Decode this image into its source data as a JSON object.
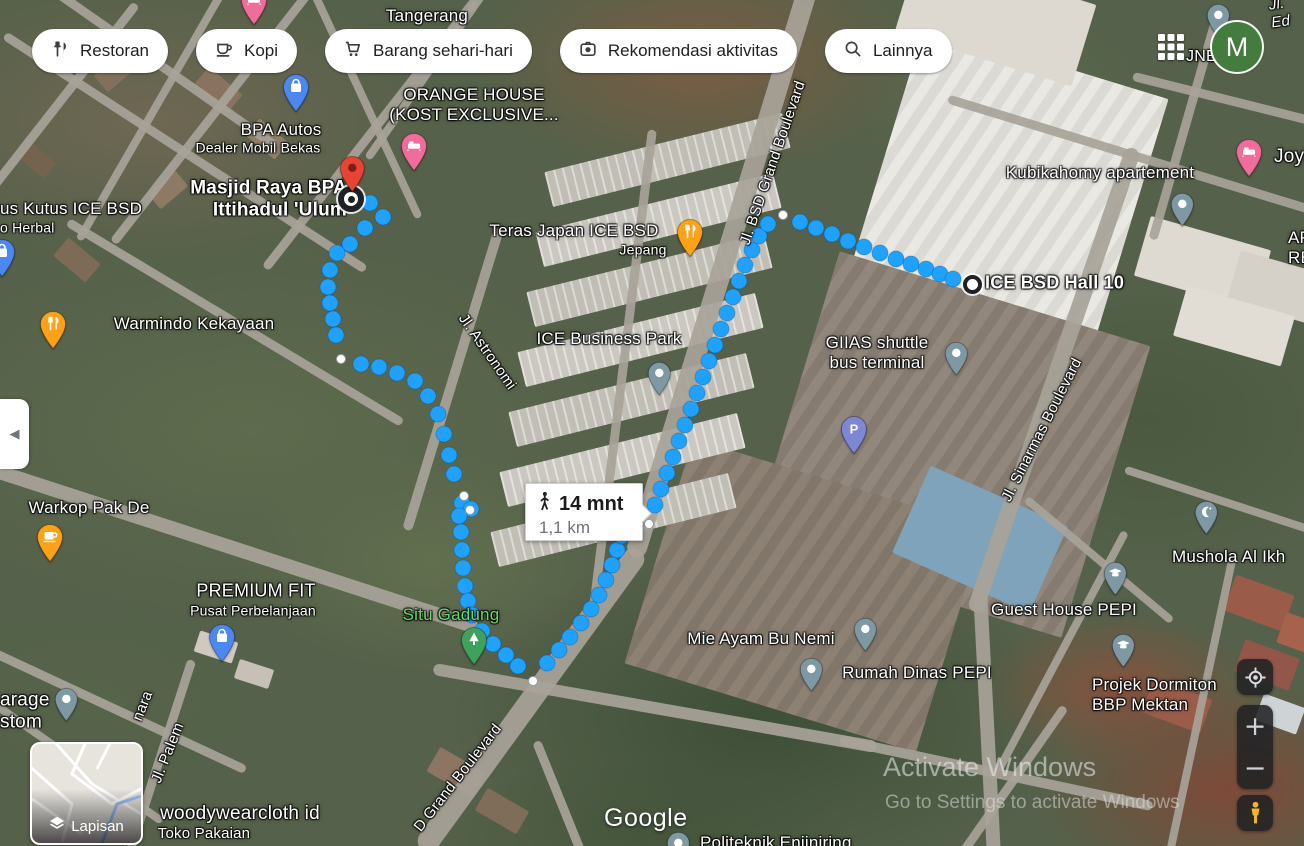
{
  "chips": [
    {
      "label": "Restoran",
      "icon": "restaurant-icon"
    },
    {
      "label": "Kopi",
      "icon": "coffee-icon"
    },
    {
      "label": "Barang sehari-hari",
      "icon": "cart-icon"
    },
    {
      "label": "Rekomendasi aktivitas",
      "icon": "camera-icon"
    },
    {
      "label": "Lainnya",
      "icon": "search-icon"
    }
  ],
  "topbar": {
    "jne_label": "JNE",
    "avatar_initial": "M"
  },
  "controls": {
    "layers_label": "Lapisan",
    "zoom_in": "+",
    "zoom_out": "−"
  },
  "watermarks": {
    "google": "Google",
    "activate_line1": "Activate Windows",
    "activate_line2": "Go to Settings to activate Windows"
  },
  "route": {
    "mode": "walking",
    "duration": "14 mnt",
    "distance": "1,1 km",
    "dot_color": "#1FA1FF",
    "start": [
      351,
      199
    ],
    "end": [
      972,
      284
    ],
    "dots": [
      [
        370,
        203
      ],
      [
        383,
        217
      ],
      [
        365,
        228
      ],
      [
        350,
        244
      ],
      [
        337,
        253
      ],
      [
        330,
        270
      ],
      [
        328,
        287
      ],
      [
        330,
        303
      ],
      [
        333,
        319
      ],
      [
        336,
        335
      ],
      [
        361,
        364
      ],
      [
        379,
        367
      ],
      [
        397,
        373
      ],
      [
        415,
        381
      ],
      [
        428,
        396
      ],
      [
        438,
        414
      ],
      [
        444,
        434
      ],
      [
        449,
        455
      ],
      [
        454,
        474
      ],
      [
        462,
        503
      ],
      [
        471,
        509
      ],
      [
        459,
        516
      ],
      [
        461,
        532
      ],
      [
        462,
        550
      ],
      [
        463,
        568
      ],
      [
        465,
        586
      ],
      [
        468,
        601
      ],
      [
        472,
        615
      ],
      [
        482,
        631
      ],
      [
        493,
        644
      ],
      [
        506,
        655
      ],
      [
        518,
        666
      ],
      [
        547,
        663
      ],
      [
        559,
        650
      ],
      [
        570,
        637
      ],
      [
        581,
        623
      ],
      [
        591,
        609
      ],
      [
        599,
        595
      ],
      [
        606,
        580
      ],
      [
        612,
        565
      ],
      [
        617,
        550
      ],
      [
        622,
        536
      ],
      [
        633,
        528
      ],
      [
        655,
        505
      ],
      [
        661,
        489
      ],
      [
        667,
        473
      ],
      [
        673,
        457
      ],
      [
        679,
        441
      ],
      [
        685,
        425
      ],
      [
        691,
        409
      ],
      [
        697,
        393
      ],
      [
        703,
        377
      ],
      [
        709,
        361
      ],
      [
        715,
        345
      ],
      [
        721,
        329
      ],
      [
        727,
        313
      ],
      [
        733,
        297
      ],
      [
        739,
        281
      ],
      [
        745,
        265
      ],
      [
        752,
        250
      ],
      [
        759,
        236
      ],
      [
        768,
        224
      ],
      [
        800,
        222
      ],
      [
        816,
        228
      ],
      [
        832,
        234
      ],
      [
        848,
        241
      ],
      [
        864,
        247
      ],
      [
        880,
        253
      ],
      [
        896,
        259
      ],
      [
        911,
        264
      ],
      [
        926,
        269
      ],
      [
        940,
        274
      ],
      [
        953,
        279
      ]
    ],
    "waypoints": [
      [
        341,
        359
      ],
      [
        464,
        496
      ],
      [
        470,
        510
      ],
      [
        533,
        681
      ],
      [
        649,
        524
      ],
      [
        783,
        215
      ]
    ]
  },
  "markers": [
    {
      "name": "pin-hotel-top",
      "x": 254,
      "y": 26,
      "color": "#F06C9B",
      "icon": "bed"
    },
    {
      "name": "pin-bpa-autos",
      "x": 296,
      "y": 113,
      "color": "#4C88F5",
      "icon": "bag"
    },
    {
      "name": "pin-left-edge-shop",
      "x": 2,
      "y": 278,
      "color": "#4C88F5",
      "icon": "bag"
    },
    {
      "name": "pin-orange-house",
      "x": 414,
      "y": 172,
      "color": "#F06C9B",
      "icon": "bed"
    },
    {
      "name": "pin-joyland",
      "x": 1249,
      "y": 178,
      "color": "#F06C9B",
      "icon": "bed"
    },
    {
      "name": "pin-warmindo-kekayaan",
      "x": 53,
      "y": 350,
      "color": "#FFA114",
      "icon": "restaurant"
    },
    {
      "name": "pin-teras-japan",
      "x": 690,
      "y": 258,
      "color": "#FFA114",
      "icon": "restaurant"
    },
    {
      "name": "pin-warkop-pak-de",
      "x": 50,
      "y": 563,
      "color": "#FFA114",
      "icon": "coffee"
    },
    {
      "name": "pin-premium-fit",
      "x": 222,
      "y": 663,
      "color": "#4C88F5",
      "icon": "bag"
    },
    {
      "name": "pin-ice-business-park",
      "x": 659,
      "y": 396,
      "color": "#7E99A3",
      "icon": "dot"
    },
    {
      "name": "pin-giias-shuttle",
      "x": 956,
      "y": 376,
      "color": "#7E99A3",
      "icon": "dot"
    },
    {
      "name": "pin-kubikahomy",
      "x": 1182,
      "y": 227,
      "color": "#7E99A3",
      "icon": "dot"
    },
    {
      "name": "pin-mie-ayam",
      "x": 865,
      "y": 652,
      "color": "#7E99A3",
      "icon": "dot"
    },
    {
      "name": "pin-rumah-dinas",
      "x": 811,
      "y": 692,
      "color": "#7E99A3",
      "icon": "dot"
    },
    {
      "name": "pin-top-right",
      "x": 1218,
      "y": 38,
      "color": "#7E99A3",
      "icon": "dot"
    },
    {
      "name": "pin-mushola",
      "x": 1206,
      "y": 535,
      "color": "#7E99A3",
      "icon": "crescent"
    },
    {
      "name": "pin-guest-house-pepi",
      "x": 1115,
      "y": 596,
      "color": "#7E99A3",
      "icon": "grad"
    },
    {
      "name": "pin-projek-dormiton",
      "x": 1123,
      "y": 668,
      "color": "#7E99A3",
      "icon": "grad"
    },
    {
      "name": "pin-parking",
      "x": 854,
      "y": 455,
      "color": "#7E86D6",
      "icon": "parking"
    },
    {
      "name": "pin-situ-gadung",
      "x": 474,
      "y": 666,
      "color": "#3FA25C",
      "icon": "tree"
    },
    {
      "name": "pin-bottom-left",
      "x": 66,
      "y": 722,
      "color": "#7E99A3",
      "icon": "dot"
    },
    {
      "name": "pin-politeknik",
      "x": 678,
      "y": 866,
      "color": "#7E99A3",
      "icon": "dot"
    },
    {
      "name": "pin-destination-red",
      "x": 352,
      "y": 193,
      "color": "#E94335",
      "icon": "red-pin"
    }
  ],
  "labels": [
    {
      "name": "label-tangerang",
      "text": "Tangerang",
      "x": 427,
      "y": 16,
      "size": 17
    },
    {
      "name": "label-orange-house",
      "text": "ORANGE HOUSE\n(KOST EXCLUSIVE...",
      "x": 474,
      "y": 105,
      "size": 17
    },
    {
      "name": "label-bpa-autos",
      "text": "BPA Autos",
      "x": 281,
      "y": 130,
      "size": 17
    },
    {
      "name": "label-bpa-autos-sub",
      "text": "Dealer Mobil Bekas",
      "x": 258,
      "y": 148,
      "size": 14,
      "weight": 400
    },
    {
      "name": "label-masjid-raya",
      "text": "Masjid Raya BPA\nIttihadul 'Ulum",
      "x": 347,
      "y": 200,
      "size": 19,
      "weight": 700,
      "align": "right"
    },
    {
      "name": "label-teras-japan",
      "text": "Teras Japan ICE BSD",
      "x": 574,
      "y": 231,
      "size": 17
    },
    {
      "name": "label-teras-japan-sub",
      "text": "Jepang",
      "x": 643,
      "y": 250,
      "size": 14,
      "weight": 400
    },
    {
      "name": "label-ice-business-park",
      "text": "ICE Business Park",
      "x": 609,
      "y": 339,
      "size": 17
    },
    {
      "name": "label-kubikahomy",
      "text": "Kubikahomy apartement",
      "x": 1100,
      "y": 173,
      "size": 17
    },
    {
      "name": "label-ice-bsd-hall-10",
      "text": "ICE BSD Hall 10",
      "x": 985,
      "y": 283,
      "size": 18,
      "weight": 700,
      "align": "left"
    },
    {
      "name": "label-giias",
      "text": "GIIAS shuttle\nbus terminal",
      "x": 877,
      "y": 353,
      "size": 17
    },
    {
      "name": "label-warmindo",
      "text": "Warmindo Kekayaan",
      "x": 194,
      "y": 324,
      "size": 17
    },
    {
      "name": "label-warkop",
      "text": "Warkop Pak De",
      "x": 89,
      "y": 508,
      "size": 17
    },
    {
      "name": "label-premium-fit",
      "text": "PREMIUM FIT",
      "x": 256,
      "y": 591,
      "size": 18
    },
    {
      "name": "label-premium-fit-sub",
      "text": "Pusat Perbelanjaan",
      "x": 253,
      "y": 611,
      "size": 14,
      "weight": 400
    },
    {
      "name": "label-situ-gadung",
      "text": "Situ Gadung",
      "x": 451,
      "y": 615,
      "size": 17,
      "color": "#68D967"
    },
    {
      "name": "label-mie-ayam",
      "text": "Mie Ayam Bu Nemi",
      "x": 761,
      "y": 639,
      "size": 17
    },
    {
      "name": "label-rumah-dinas",
      "text": "Rumah Dinas PEPI",
      "x": 917,
      "y": 673,
      "size": 17
    },
    {
      "name": "label-guest-house",
      "text": "Guest House PEPI",
      "x": 1064,
      "y": 610,
      "size": 17
    },
    {
      "name": "label-mushola",
      "text": "Mushola Al Ikh",
      "x": 1172,
      "y": 557,
      "size": 17,
      "align": "left"
    },
    {
      "name": "label-projek-dormiton",
      "text": "Projek Dormiton\nBBP Mektan",
      "x": 1092,
      "y": 695,
      "size": 17,
      "align": "left"
    },
    {
      "name": "label-woodywearcloth",
      "text": "woodywearcloth id",
      "x": 240,
      "y": 814,
      "size": 19
    },
    {
      "name": "label-woodywearcloth-sub",
      "text": "Toko Pakaian",
      "x": 204,
      "y": 834,
      "size": 15,
      "weight": 400
    },
    {
      "name": "label-kutus",
      "text": "us Kutus ICE BSD",
      "x": 0,
      "y": 209,
      "size": 17,
      "align": "left"
    },
    {
      "name": "label-kutus-sub",
      "text": "o Herbal",
      "x": 0,
      "y": 228,
      "size": 14,
      "weight": 400,
      "align": "left"
    },
    {
      "name": "label-garage",
      "text": "arage\nstom",
      "x": 0,
      "y": 712,
      "size": 19,
      "align": "left"
    },
    {
      "name": "label-joyl",
      "text": "Joyl",
      "x": 1274,
      "y": 157,
      "size": 19,
      "align": "left"
    },
    {
      "name": "label-ap-re",
      "text": "AP\nRE",
      "x": 1288,
      "y": 248,
      "size": 17,
      "align": "left"
    },
    {
      "name": "label-jl-ed",
      "text": "Jl. Ed",
      "x": 1270,
      "y": 12,
      "size": 15,
      "italic": true,
      "rotate": -8,
      "align": "left"
    },
    {
      "name": "label-politeknik",
      "text": "Politeknik Enjiniring",
      "x": 700,
      "y": 843,
      "size": 17,
      "align": "left"
    },
    {
      "name": "label-jl-astronomi",
      "text": "Jl. Astronomi",
      "x": 487,
      "y": 352,
      "size": 15,
      "rotate": 55
    },
    {
      "name": "label-jl-bsd-grand",
      "text": "Jl. BSD Grand Boulevard",
      "x": 773,
      "y": 163,
      "size": 15,
      "rotate": -71
    },
    {
      "name": "label-jl-sinarmas",
      "text": "Jl. Sinarmas Boulevard",
      "x": 1042,
      "y": 430,
      "size": 15,
      "rotate": -63
    },
    {
      "name": "label-jl-palem",
      "text": "Jl. Palem",
      "x": 168,
      "y": 753,
      "size": 15,
      "rotate": -68
    },
    {
      "name": "label-grand-blvd-bottom",
      "text": "D Grand Boulevard",
      "x": 458,
      "y": 778,
      "size": 15,
      "rotate": -52
    },
    {
      "name": "label-nara",
      "text": "nara",
      "x": 143,
      "y": 706,
      "size": 15,
      "rotate": -68
    }
  ]
}
